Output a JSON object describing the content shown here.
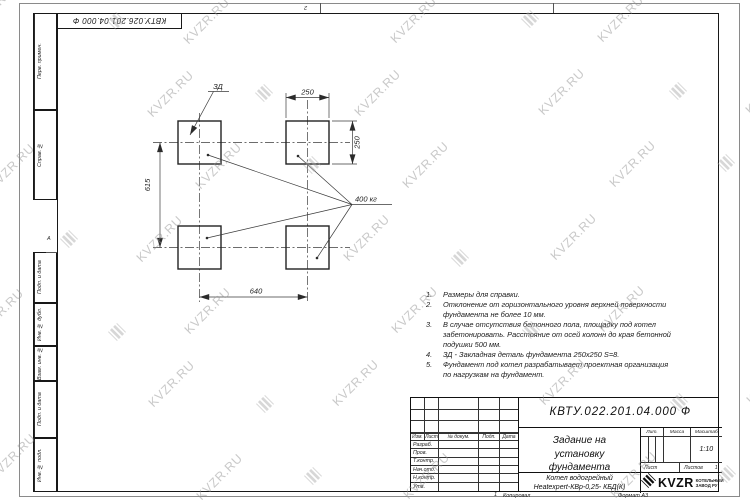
{
  "watermark": {
    "text": "KVZR.RU"
  },
  "top_stamp": {
    "doc_number": "КВТУ.026.201.04.000 Ф"
  },
  "zones": {
    "top": "2",
    "left": "А",
    "bottom": "1"
  },
  "margin_stamps": {
    "perv": "Перв. примен.",
    "sprav": "Справ. №",
    "podp1": "Подп. и дата",
    "inv_dubl": "Инв. № дубл.",
    "vzam": "Взам. инв. №",
    "podp2": "Подп. и дата",
    "inv_podl": "Инв. № подл."
  },
  "drawing": {
    "dim_top": "250",
    "dim_right": "250",
    "dim_left": "615",
    "dim_bottom": "640",
    "load_label": "400 кг",
    "detail_label": "ЗД"
  },
  "notes": {
    "items": [
      {
        "num": "1.",
        "text": "Размеры для справки."
      },
      {
        "num": "2.",
        "text": "Отклонение от горизонтального уровня верхней поверхности фундамента не более 10 мм."
      },
      {
        "num": "3.",
        "text": "В случае отсутствия бетонного пола, площадку под котел забетонировать. Расстояние от осей колонн до края бетонной подушки 500 мм."
      },
      {
        "num": "4.",
        "text": "ЗД - Закладная деталь фундамента 250х250 S=8."
      },
      {
        "num": "5.",
        "text": "Фундамент под котел разрабатывает проектная организация по нагрузкам на фундамент."
      }
    ]
  },
  "title_block": {
    "doc_number": "КВТУ.022.201.04.000 Ф",
    "title": "Задание на установку фундамента",
    "product_line1": "Котел водогрейный",
    "product_line2": "Heatexpert-КВр-0,25- КБД(К)",
    "header": {
      "izm": "Изм.",
      "list": "Лист",
      "doc": "№ докум.",
      "podp": "Подп.",
      "data": "Дата"
    },
    "roles": [
      "Разраб.",
      "Пров.",
      "Т.контр.",
      "Нач.отд.",
      "Н.контр.",
      "Утв."
    ],
    "lit_label": "Лит.",
    "mass_label": "Масса",
    "scale_label": "Масштаб",
    "scale_value": "1:10",
    "sheet_label": "Лист",
    "sheets_label": "Листов",
    "sheets_value": "1",
    "logo": {
      "text": "KVZR",
      "subtext": "КОТЕЛЬНЫЙ ЗАВОД РУ"
    },
    "copied": "Копировал",
    "format": "Формат А3"
  }
}
